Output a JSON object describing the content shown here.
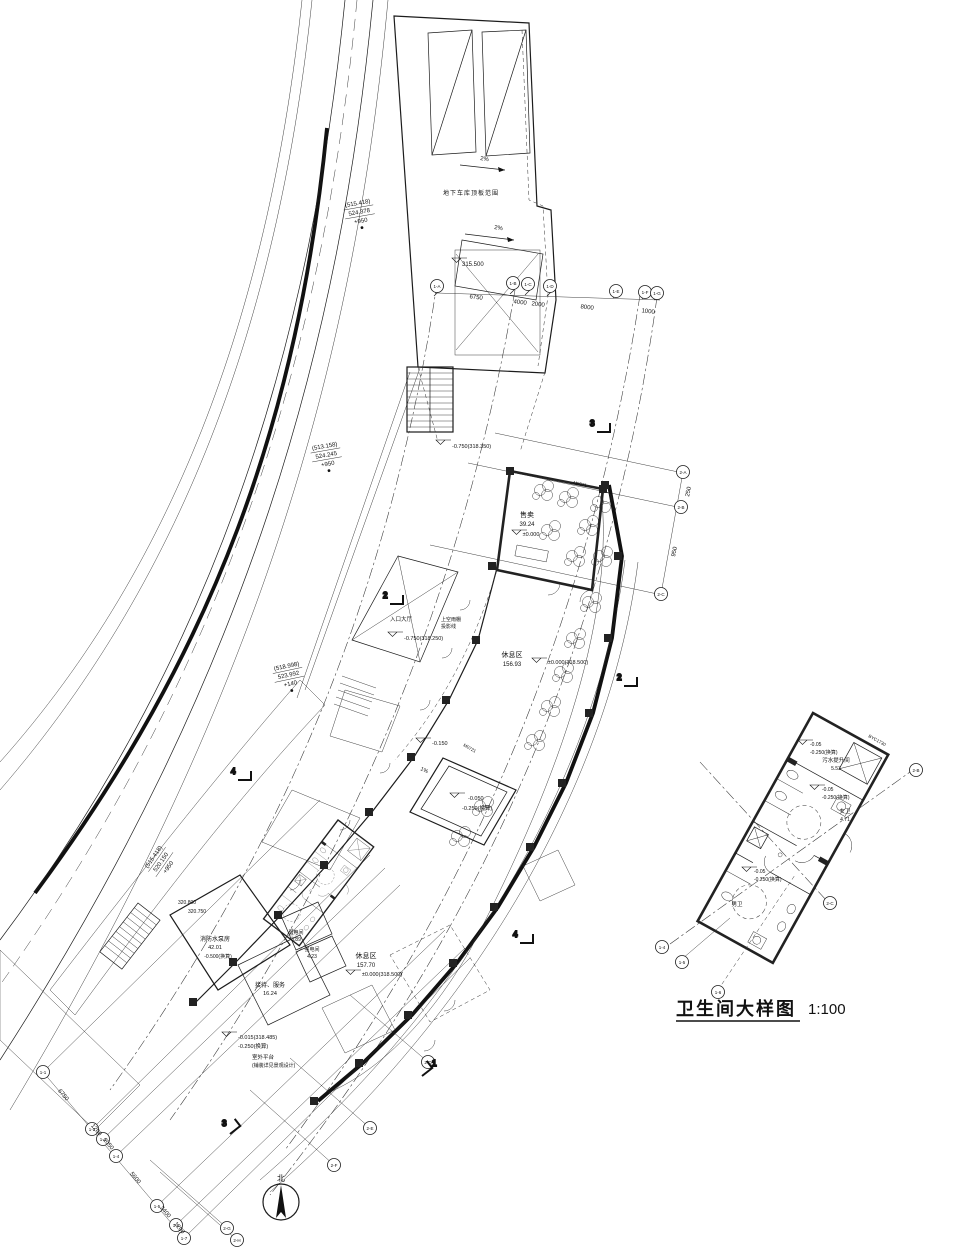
{
  "page": {
    "background": "#ffffff",
    "ink": "#1c1c1c"
  },
  "detail": {
    "title": "卫生间大样图",
    "scale": "1:100"
  },
  "north": {
    "label": "北"
  },
  "rooms": {
    "tea": {
      "name": "售卖",
      "area": "39.24",
      "level": "±0.000"
    },
    "rest_upper": {
      "name": "休息区",
      "area": "156.93",
      "level": "±0.000(318.500)"
    },
    "rest_lower": {
      "name": "休息区",
      "area": "157.70",
      "level": "±0.000(318.500)"
    },
    "pump": {
      "name": "消防水泵房",
      "area": "42.01",
      "level": "-0.500(换算)"
    },
    "reception": {
      "name": "接待、服务",
      "area": "16.24"
    },
    "weak_elec": {
      "name": "弱电间",
      "area": "3.89"
    },
    "strong_elec": {
      "name": "强电间",
      "area": "4.23"
    },
    "entrance": {
      "name": "入口大厅"
    },
    "sewage": {
      "name": "污水提升间",
      "area": "5.53"
    },
    "female_wc": {
      "name": "女卫",
      "area": "4.71"
    },
    "male_wc": {
      "name": "男卫"
    }
  },
  "labels": {
    "garage_note": "地下车库顶板范围",
    "ramp_level": "315.500",
    "slope1": "2%",
    "slope2": "2%",
    "slope3": "1%",
    "canopy1": "上空雨棚",
    "canopy2": "投影线",
    "entry_level": "-0.750(318.250)",
    "entry_level2": "-0.750(318.350)",
    "court_level1": "-0.150",
    "court_level2": "-0.250(换算)",
    "court_level3": "-0.050",
    "stair_level1": "320.800",
    "stair_level2": "320.750",
    "platform_level1": "-0.015(318.485)",
    "platform_level2": "-0.250(换算)",
    "platform_note1": "室外平台",
    "platform_note2": "(铺装详见景观设计)",
    "det_lv1a": "-0.05",
    "det_lv1b": "-0.250(换算)",
    "det_lv2a": "-0.05",
    "det_lv2b": "-0.250(换算)",
    "det_lv3a": "-0.05",
    "det_lv3b": "-0.250(换算)",
    "door_tag1": "BYC1730",
    "door_tag2": "M0921",
    "door_tag3": "M0721"
  },
  "road_labels": [
    {
      "l1": "(515.418)",
      "l2": "524.378",
      "l3": "+950"
    },
    {
      "l1": "(513.158)",
      "l2": "524.245",
      "l3": "+950"
    },
    {
      "l1": "(518.998)",
      "l2": "523.992",
      "l3": "+140"
    },
    {
      "l1": "(515.418)",
      "l2": "520.150",
      "l3": "+950"
    }
  ],
  "dims": {
    "top": [
      "6750",
      "4000",
      "2000",
      "8000",
      "1000"
    ],
    "right": [
      "250",
      "950"
    ],
    "bottom": [
      "6750",
      "1200",
      "2050",
      "5600",
      "2400",
      "1200"
    ]
  },
  "sections": [
    "1",
    "2",
    "3",
    "4"
  ],
  "axes": {
    "top": [
      "1-A",
      "1-B",
      "1-C",
      "1-D",
      "1-E",
      "1-F",
      "1-G"
    ],
    "right": [
      "2-A",
      "2-B",
      "2-C"
    ],
    "mid": [
      "2-D",
      "2-E",
      "2-F",
      "2-G",
      "2-H"
    ],
    "bottom": [
      "1-1",
      "1-2",
      "1-3",
      "1-4",
      "1-5",
      "1-6",
      "1-7"
    ],
    "detail": [
      "2-B",
      "2-C",
      "1-4",
      "1-5",
      "1-6"
    ]
  }
}
